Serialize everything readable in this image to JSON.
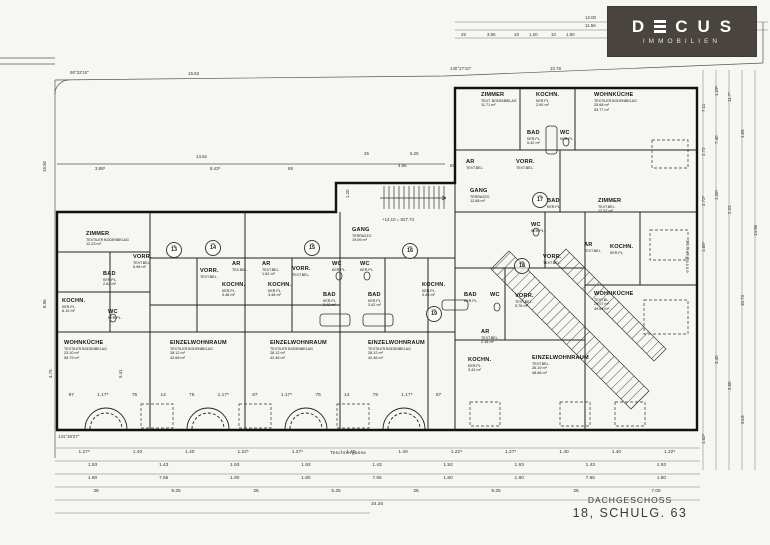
{
  "logo": {
    "brand": "DECUS",
    "sub": "IMMOBILIEN",
    "bg": "#4a443e",
    "fg": "#ffffff"
  },
  "title_block": {
    "floor": "DACHGESCHOSS",
    "address": "18, SCHULG. 63"
  },
  "streets": {
    "bottom": "Teschnergasse",
    "right": "Schulgasse"
  },
  "units": {
    "prefix": "WE",
    "list": [
      {
        "x": 166,
        "y": 242,
        "no": "13"
      },
      {
        "x": 205,
        "y": 240,
        "no": "14"
      },
      {
        "x": 304,
        "y": 240,
        "no": "15"
      },
      {
        "x": 402,
        "y": 243,
        "no": "16"
      },
      {
        "x": 532,
        "y": 192,
        "no": "17"
      },
      {
        "x": 514,
        "y": 258,
        "no": "18"
      },
      {
        "x": 426,
        "y": 306,
        "no": "19"
      }
    ]
  },
  "rooms": [
    {
      "x": 86,
      "y": 231,
      "n": "ZIMMER",
      "s": "TEXTILER BODENBELAG",
      "a": "12.23 m²"
    },
    {
      "x": 133,
      "y": 254,
      "n": "VORR.",
      "s": "TEXT.BEL.",
      "a": "5.98 m²"
    },
    {
      "x": 103,
      "y": 271,
      "n": "BAD",
      "s": "KER.PL.",
      "a": "2.62 m²"
    },
    {
      "x": 62,
      "y": 298,
      "n": "KOCHN.",
      "s": "KER.PL.",
      "a": "6.10 m²"
    },
    {
      "x": 108,
      "y": 309,
      "n": "WC",
      "s": "KER.PL."
    },
    {
      "x": 64,
      "y": 340,
      "n": "WOHNKÜCHE",
      "s": "TEXTILER BODENBELAG",
      "a": "23.10 m²",
      "a2": "56.79 m²"
    },
    {
      "x": 170,
      "y": 340,
      "n": "EINZELWOHNRAUM",
      "s": "TEXTILER BODENBELAG",
      "a": "28.12 m²",
      "a2": "42.68 m²"
    },
    {
      "x": 200,
      "y": 268,
      "n": "VORR.",
      "s": "TEXT.BEL."
    },
    {
      "x": 232,
      "y": 261,
      "n": "AR",
      "s": "TEX.BEL."
    },
    {
      "x": 262,
      "y": 261,
      "n": "AR",
      "s": "TEXT.BEL.",
      "a": "1.62 m²"
    },
    {
      "x": 292,
      "y": 266,
      "n": "VORR.",
      "s": "TEXT.BEL."
    },
    {
      "x": 332,
      "y": 261,
      "n": "WC",
      "s": "KER.PL."
    },
    {
      "x": 360,
      "y": 261,
      "n": "WC",
      "s": "KER.PL."
    },
    {
      "x": 222,
      "y": 282,
      "n": "KOCHN.",
      "s": "KER.PL.",
      "a": "3.48 m²"
    },
    {
      "x": 268,
      "y": 282,
      "n": "KOCHN.",
      "s": "KER.PL.",
      "a": "3.48 m²"
    },
    {
      "x": 323,
      "y": 292,
      "n": "BAD",
      "s": "KER.PL.",
      "a": "3.42 m²"
    },
    {
      "x": 368,
      "y": 292,
      "n": "BAD",
      "s": "KER.PL.",
      "a": "3.42 m²"
    },
    {
      "x": 270,
      "y": 340,
      "n": "EINZELWOHNRAUM",
      "s": "TEXTILER BODENBELAG",
      "a": "28.12 m²",
      "a2": "42.46 m²"
    },
    {
      "x": 368,
      "y": 340,
      "n": "EINZELWOHNRAUM",
      "s": "TEXTILER BODENBELAG",
      "a": "28.12 m²",
      "a2": "42.46 m²"
    },
    {
      "x": 352,
      "y": 227,
      "n": "GANG",
      "s": "TERRAZZO",
      "a": "19.09 m²"
    },
    {
      "x": 470,
      "y": 188,
      "n": "GANG",
      "s": "TERRAZZO",
      "a": "12.68 m²"
    },
    {
      "x": 422,
      "y": 282,
      "n": "KOCHN.",
      "s": "KER.PL.",
      "a": "3.48 m²"
    },
    {
      "x": 464,
      "y": 292,
      "n": "BAD",
      "s": "KER.PL."
    },
    {
      "x": 490,
      "y": 292,
      "n": "WC"
    },
    {
      "x": 515,
      "y": 293,
      "n": "VORR.",
      "s": "TEXT.BEL.",
      "a": "5.78 m²"
    },
    {
      "x": 481,
      "y": 329,
      "n": "AR",
      "s": "TEXT.BEL.",
      "a": "2.16 m²"
    },
    {
      "x": 468,
      "y": 357,
      "n": "KOCHN.",
      "s": "KER.PL.",
      "a": "3.43 m²"
    },
    {
      "x": 532,
      "y": 355,
      "n": "EINZELWOHNRAUM",
      "s": "TEXT.BEL.",
      "a": "26.19 m²",
      "a2": "48.66 m²"
    },
    {
      "x": 527,
      "y": 130,
      "n": "BAD",
      "s": "KER.PL.",
      "a": "5.42 m²"
    },
    {
      "x": 560,
      "y": 130,
      "n": "WC",
      "s": "KER.PL."
    },
    {
      "x": 466,
      "y": 159,
      "n": "AR",
      "s": "TEXT.BEL."
    },
    {
      "x": 516,
      "y": 159,
      "n": "VORR.",
      "s": "TEXT.BEL."
    },
    {
      "x": 481,
      "y": 92,
      "n": "ZIMMER",
      "s": "TEXT. BODENBELAG",
      "a": "11.71 m²"
    },
    {
      "x": 536,
      "y": 92,
      "n": "KOCHN.",
      "s": "KER.PL.",
      "a": "2.90 m²"
    },
    {
      "x": 594,
      "y": 92,
      "n": "WOHNKÜCHE",
      "s": "TEXTILER BODENBELAG",
      "a": "25.68 m²",
      "a2": "53.77 m²"
    },
    {
      "x": 598,
      "y": 198,
      "n": "ZIMMER",
      "s": "TEXT.BEL.",
      "a": "12.57 m²"
    },
    {
      "x": 584,
      "y": 242,
      "n": "AR",
      "s": "TEXT.BEL."
    },
    {
      "x": 610,
      "y": 244,
      "n": "KOCHN.",
      "s": "KER.PL."
    },
    {
      "x": 594,
      "y": 291,
      "n": "WOHNKÜCHE",
      "s": "TEXT.BL.",
      "a": "29.07 m²",
      "a2": "49.64 m²"
    },
    {
      "x": 547,
      "y": 198,
      "n": "BAD",
      "s": "KER.PL."
    },
    {
      "x": 531,
      "y": 222,
      "n": "WC",
      "s": "KER.PL."
    },
    {
      "x": 543,
      "y": 254,
      "n": "VORR.",
      "s": "TEXT.BEL."
    }
  ],
  "dims": [
    {
      "t": "90°32'10''",
      "x": 70,
      "y": 70
    },
    {
      "t": "140°27'10''",
      "x": 450,
      "y": 66
    },
    {
      "t": "141°28'27''",
      "x": 58,
      "y": 434
    },
    {
      "t": "15.63",
      "x": 188,
      "y": 71
    },
    {
      "t": "10.78",
      "x": 550,
      "y": 66
    },
    {
      "t": "12.00",
      "x": 585,
      "y": 15
    },
    {
      "t": "11.56",
      "x": 585,
      "y": 23
    },
    {
      "t": "25",
      "x": 461,
      "y": 32
    },
    {
      "t": "3.85",
      "x": 487,
      "y": 32
    },
    {
      "t": "10",
      "x": 514,
      "y": 32
    },
    {
      "t": "1.20",
      "x": 529,
      "y": 32
    },
    {
      "t": "10",
      "x": 551,
      "y": 32
    },
    {
      "t": "1.80",
      "x": 566,
      "y": 32
    },
    {
      "t": "14.62",
      "x": 196,
      "y": 154
    },
    {
      "t": "3.88⁵",
      "x": 95,
      "y": 166
    },
    {
      "t": "8.43⁵",
      "x": 210,
      "y": 166
    },
    {
      "t": "88",
      "x": 288,
      "y": 166
    },
    {
      "t": "25",
      "x": 364,
      "y": 151
    },
    {
      "t": "5.25",
      "x": 410,
      "y": 151
    },
    {
      "t": "4.95",
      "x": 398,
      "y": 163
    },
    {
      "t": "55",
      "x": 450,
      "y": 163
    },
    {
      "t": "+14.10 = 827.74",
      "x": 382,
      "y": 217
    },
    {
      "t": "1.20",
      "x": 345,
      "y": 198,
      "r": -90
    },
    {
      "t": "18.50",
      "x": 42,
      "y": 172,
      "r": -90
    },
    {
      "t": "8.96",
      "x": 42,
      "y": 308,
      "r": -90
    },
    {
      "t": "4.75",
      "x": 48,
      "y": 378,
      "r": -90
    },
    {
      "t": "5.41",
      "x": 118,
      "y": 378,
      "r": -90
    },
    {
      "t": "7.11",
      "x": 701,
      "y": 112,
      "r": -90
    },
    {
      "t": "1.29⁵",
      "x": 714,
      "y": 96,
      "r": -90
    },
    {
      "t": "11.7⁵",
      "x": 727,
      "y": 102,
      "r": -90
    },
    {
      "t": "2.72",
      "x": 701,
      "y": 156,
      "r": -90
    },
    {
      "t": "7.40",
      "x": 714,
      "y": 144,
      "r": -90
    },
    {
      "t": "1.65",
      "x": 740,
      "y": 138,
      "r": -90
    },
    {
      "t": "2.72⁵",
      "x": 701,
      "y": 206,
      "r": -90
    },
    {
      "t": "1.36⁵",
      "x": 714,
      "y": 200,
      "r": -90
    },
    {
      "t": "2.23",
      "x": 727,
      "y": 214,
      "r": -90
    },
    {
      "t": "14.96",
      "x": 753,
      "y": 236,
      "r": -90
    },
    {
      "t": "1.66⁵",
      "x": 701,
      "y": 252,
      "r": -90
    },
    {
      "t": "10.73",
      "x": 740,
      "y": 306,
      "r": -90
    },
    {
      "t": "3.40",
      "x": 714,
      "y": 364,
      "r": -90
    },
    {
      "t": "3.60",
      "x": 727,
      "y": 390,
      "r": -90
    },
    {
      "t": "24.8",
      "x": 740,
      "y": 424,
      "r": -90
    },
    {
      "t": "1.62⁵",
      "x": 701,
      "y": 444,
      "r": -90
    }
  ],
  "dim_rows": {
    "windows": [
      "87",
      "1.17⁵",
      "75",
      "14",
      "75",
      "1.17⁵",
      "87",
      "1.17⁵",
      "75",
      "14",
      "75",
      "1.17⁵",
      "87"
    ],
    "row1": [
      "1.27⁵",
      "1.40",
      "1.40",
      "1.22⁵",
      "1.27⁵",
      "1.40",
      "1.40",
      "1.22⁵",
      "1.27⁵",
      "1.40",
      "1.40",
      "1.22⁵"
    ],
    "row2": [
      "1.93",
      "1.43",
      "1.93",
      "1.93",
      "1.43",
      "1.92",
      "1.93",
      "1.43",
      "1.93"
    ],
    "row3": [
      "1.80",
      "7.65",
      "1.80",
      "1.80",
      "7.65",
      "1.80",
      "1.80",
      "7.65",
      "1.80"
    ],
    "row4": [
      "38",
      "9.25",
      "25",
      "5.25",
      "25",
      "9.25",
      "25",
      "7.06"
    ],
    "total": [
      "34.26"
    ]
  }
}
